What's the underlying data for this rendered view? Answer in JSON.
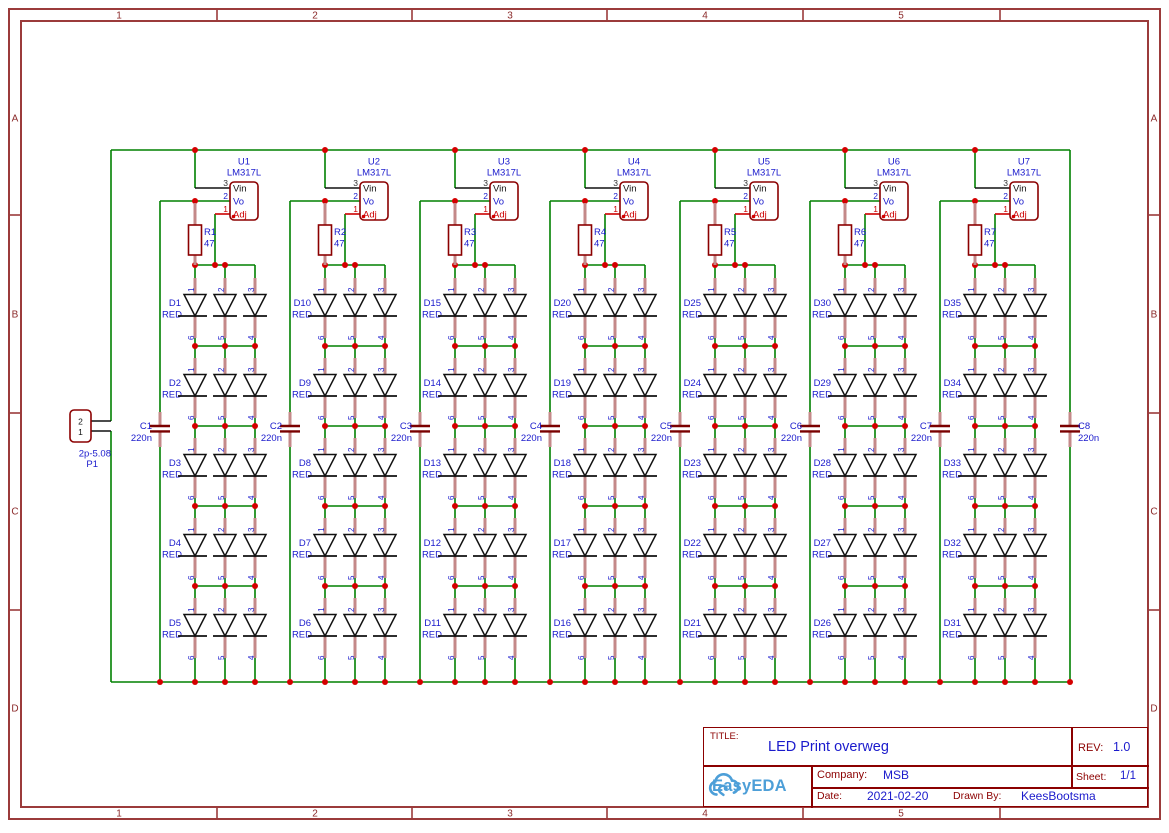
{
  "frame": {
    "column_labels": [
      "1",
      "2",
      "3",
      "4",
      "5"
    ],
    "row_labels": [
      "A",
      "B",
      "C",
      "D"
    ]
  },
  "title_block": {
    "title_label": "TITLE:",
    "title": "LED Print overweg",
    "rev_label": "REV:",
    "rev": "1.0",
    "company_label": "Company:",
    "company": "MSB",
    "sheet_label": "Sheet:",
    "sheet": "1/1",
    "date_label": "Date:",
    "date": "2021-02-20",
    "drawn_by_label": "Drawn By:",
    "drawn_by": "KeesBootsma",
    "logo_text": "EasyEDA"
  },
  "connector": {
    "ref": "P1",
    "value": "2p-5.08",
    "pin_numbers": [
      "2",
      "1"
    ]
  },
  "regulator_pins": [
    {
      "num": "3",
      "name": "Vin"
    },
    {
      "num": "2",
      "name": "Vo"
    },
    {
      "num": "1",
      "name": "Adj"
    }
  ],
  "led_pin_numbers": {
    "top": [
      "1",
      "2",
      "3"
    ],
    "bottom": [
      "6",
      "5",
      "4"
    ]
  },
  "input_capacitor": {
    "ref": "C8",
    "value": "220n"
  },
  "columns": [
    {
      "regulator": {
        "ref": "U1",
        "value": "LM317L"
      },
      "resistor": {
        "ref": "R1",
        "value": "47"
      },
      "capacitor": {
        "ref": "C1",
        "value": "220n"
      },
      "leds": [
        {
          "ref": "D1",
          "value": "RED"
        },
        {
          "ref": "D2",
          "value": "RED"
        },
        {
          "ref": "D3",
          "value": "RED"
        },
        {
          "ref": "D4",
          "value": "RED"
        },
        {
          "ref": "D5",
          "value": "RED"
        }
      ]
    },
    {
      "regulator": {
        "ref": "U2",
        "value": "LM317L"
      },
      "resistor": {
        "ref": "R2",
        "value": "47"
      },
      "capacitor": {
        "ref": "C2",
        "value": "220n"
      },
      "leds": [
        {
          "ref": "D10",
          "value": "RED"
        },
        {
          "ref": "D9",
          "value": "RED"
        },
        {
          "ref": "D8",
          "value": "RED"
        },
        {
          "ref": "D7",
          "value": "RED"
        },
        {
          "ref": "D6",
          "value": "RED"
        }
      ]
    },
    {
      "regulator": {
        "ref": "U3",
        "value": "LM317L"
      },
      "resistor": {
        "ref": "R3",
        "value": "47"
      },
      "capacitor": {
        "ref": "C3",
        "value": "220n"
      },
      "leds": [
        {
          "ref": "D15",
          "value": "RED"
        },
        {
          "ref": "D14",
          "value": "RED"
        },
        {
          "ref": "D13",
          "value": "RED"
        },
        {
          "ref": "D12",
          "value": "RED"
        },
        {
          "ref": "D11",
          "value": "RED"
        }
      ]
    },
    {
      "regulator": {
        "ref": "U4",
        "value": "LM317L"
      },
      "resistor": {
        "ref": "R4",
        "value": "47"
      },
      "capacitor": {
        "ref": "C4",
        "value": "220n"
      },
      "leds": [
        {
          "ref": "D20",
          "value": "RED"
        },
        {
          "ref": "D19",
          "value": "RED"
        },
        {
          "ref": "D18",
          "value": "RED"
        },
        {
          "ref": "D17",
          "value": "RED"
        },
        {
          "ref": "D16",
          "value": "RED"
        }
      ]
    },
    {
      "regulator": {
        "ref": "U5",
        "value": "LM317L"
      },
      "resistor": {
        "ref": "R5",
        "value": "47"
      },
      "capacitor": {
        "ref": "C5",
        "value": "220n"
      },
      "leds": [
        {
          "ref": "D25",
          "value": "RED"
        },
        {
          "ref": "D24",
          "value": "RED"
        },
        {
          "ref": "D23",
          "value": "RED"
        },
        {
          "ref": "D22",
          "value": "RED"
        },
        {
          "ref": "D21",
          "value": "RED"
        }
      ]
    },
    {
      "regulator": {
        "ref": "U6",
        "value": "LM317L"
      },
      "resistor": {
        "ref": "R6",
        "value": "47"
      },
      "capacitor": {
        "ref": "C6",
        "value": "220n"
      },
      "leds": [
        {
          "ref": "D30",
          "value": "RED"
        },
        {
          "ref": "D29",
          "value": "RED"
        },
        {
          "ref": "D28",
          "value": "RED"
        },
        {
          "ref": "D27",
          "value": "RED"
        },
        {
          "ref": "D26",
          "value": "RED"
        }
      ]
    },
    {
      "regulator": {
        "ref": "U7",
        "value": "LM317L"
      },
      "resistor": {
        "ref": "R7",
        "value": "47"
      },
      "capacitor": {
        "ref": "C7",
        "value": "220n"
      },
      "leds": [
        {
          "ref": "D35",
          "value": "RED"
        },
        {
          "ref": "D34",
          "value": "RED"
        },
        {
          "ref": "D33",
          "value": "RED"
        },
        {
          "ref": "D32",
          "value": "RED"
        },
        {
          "ref": "D31",
          "value": "RED"
        }
      ]
    }
  ],
  "colors": {
    "wire": "#008000",
    "pin": "#c48989",
    "junction": "#d40000",
    "outline": "#8b0000",
    "plate": "#7a0000",
    "label_blue": "#1a1acc",
    "frame": "#9b3b3b",
    "diode": "#111111",
    "pin_red": "#cc0000",
    "pin_black": "#333333",
    "logo_blue": "#4d9fd8"
  }
}
